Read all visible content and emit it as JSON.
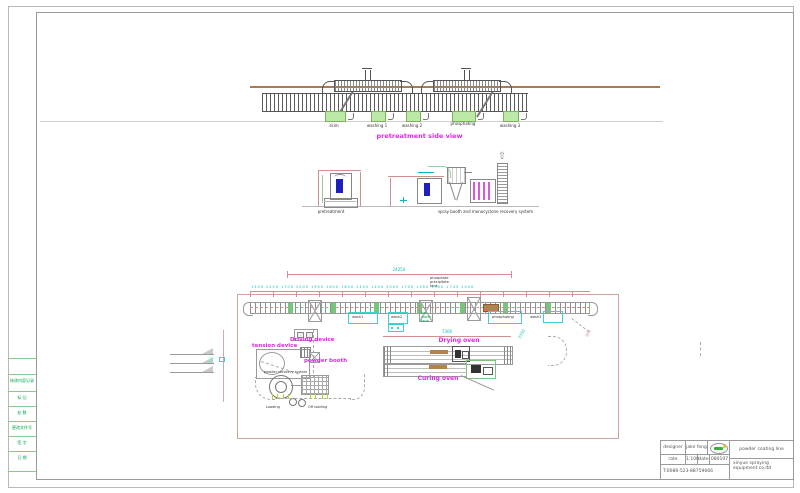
{
  "frame": {
    "revision_rows": [
      "修改内容记录",
      "标  记",
      "处  数",
      "更改文件号",
      "签  字",
      "日  期"
    ]
  },
  "elevation": {
    "title": "pretreatment side view",
    "tank_labels": [
      "skim",
      "washing 1",
      "washing 2",
      "phosphating",
      "washing 3"
    ]
  },
  "cross_sections": {
    "pretreatment_label": "pretreatment",
    "booth_label": "spray booth and monocyclone recovery system"
  },
  "plan": {
    "overall_dim": "24254",
    "segment_dims": [
      "1500",
      "1250",
      "1700",
      "2000",
      "1950",
      "1600",
      "1800",
      "1445",
      "1400",
      "2000",
      "1700",
      "1250",
      "1500",
      "1745",
      "2000"
    ],
    "oven_dim": "7300",
    "right_dim": "7350",
    "corner_dim": "900",
    "phosphate_note_1": "phosphate",
    "phosphate_note_2": "precipitate",
    "phosphate_note_3": "tank",
    "hot_water_1": "hot",
    "hot_water_2": "water",
    "hot_water_3": "tank",
    "tension_device": "tension device",
    "driving_device": "Driving device",
    "powder_booth": "powder booth",
    "powder_recovery": "powder recovery system",
    "loading": "Loading",
    "off_loading": "Off loading",
    "drying_oven": "Drying oven",
    "curing_oven": "Curing oven",
    "wash1": "wash1",
    "wash2": "wash2",
    "phosphating": "phosphating",
    "wash3": "wash3"
  },
  "title_block": {
    "designer_label": "designer",
    "designer_value": "jake feng",
    "rate_label": "rate",
    "rate_value": "1:100",
    "date_label": "date",
    "date_value": "080107",
    "phone": "T:0086-523-88759666",
    "project": "powder coating line",
    "company_line1": "xinyue spraying",
    "company_line2": "equipment co.ltd"
  },
  "colors": {
    "magenta": "#e525e5",
    "cyan": "#00bdbd",
    "green_text": "#00a651",
    "tank_fill": "#bce8a8",
    "brown_line": "#a87c4f",
    "blue_part": "#1f1fbf"
  }
}
